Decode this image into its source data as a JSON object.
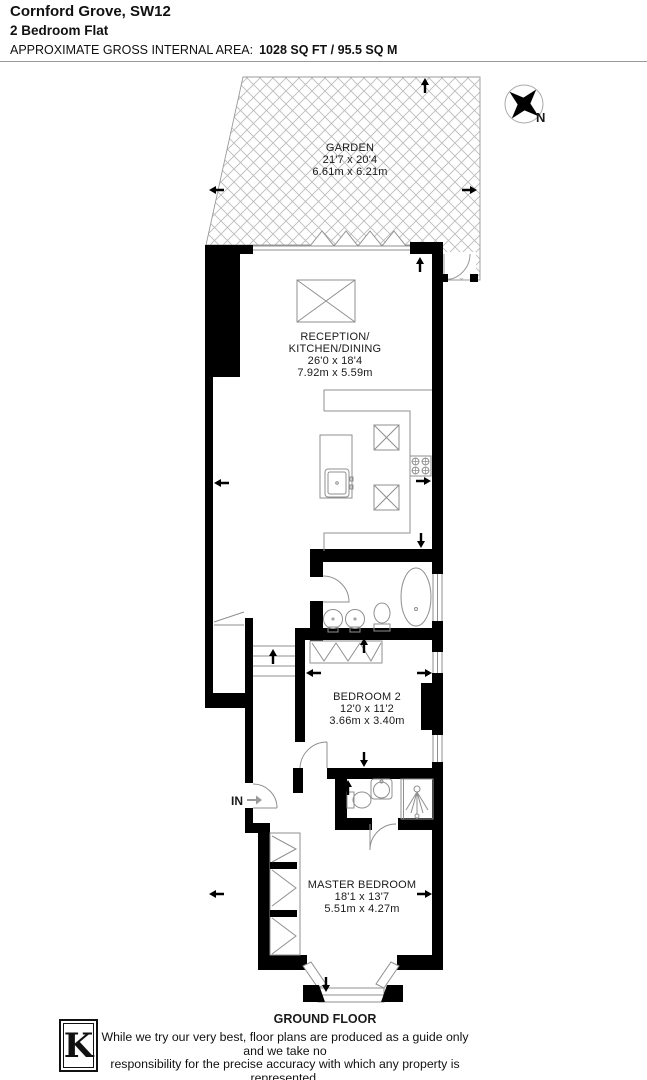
{
  "header": {
    "title": "Cornford Grove, SW12",
    "subtitle": "2 Bedroom Flat",
    "area_label": "APPROXIMATE GROSS INTERNAL AREA:",
    "area_value": "1028 SQ FT / 95.5 SQ M"
  },
  "compass": {
    "north_label": "N"
  },
  "rooms": {
    "garden": {
      "name": "GARDEN",
      "dims_ft": "21'7 x 20'4",
      "dims_m": "6.61m x 6.21m"
    },
    "reception": {
      "name_line1": "RECEPTION/",
      "name_line2": "KITCHEN/DINING",
      "dims_ft": "26'0 x 18'4",
      "dims_m": "7.92m x 5.59m"
    },
    "bedroom2": {
      "name": "BEDROOM 2",
      "dims_ft": "12'0 x 11'2",
      "dims_m": "3.66m x 3.40m"
    },
    "master_bedroom": {
      "name": "MASTER BEDROOM",
      "dims_ft": "18'1 x 13'7",
      "dims_m": "5.51m x 4.27m"
    }
  },
  "plan": {
    "entrance_label": "IN",
    "floor_label": "GROUND FLOOR"
  },
  "footer": {
    "logo_letter": "K",
    "disclaimer_line1": "While we try our very best, floor plans are produced as a guide only and we take no",
    "disclaimer_line2": "responsibility for the precise accuracy with which any property is represented."
  },
  "colors": {
    "wall": "#000000",
    "fixture_line": "#8f8f8f",
    "hatch_line": "#bcbcbc",
    "text": "#1a1a1a"
  }
}
